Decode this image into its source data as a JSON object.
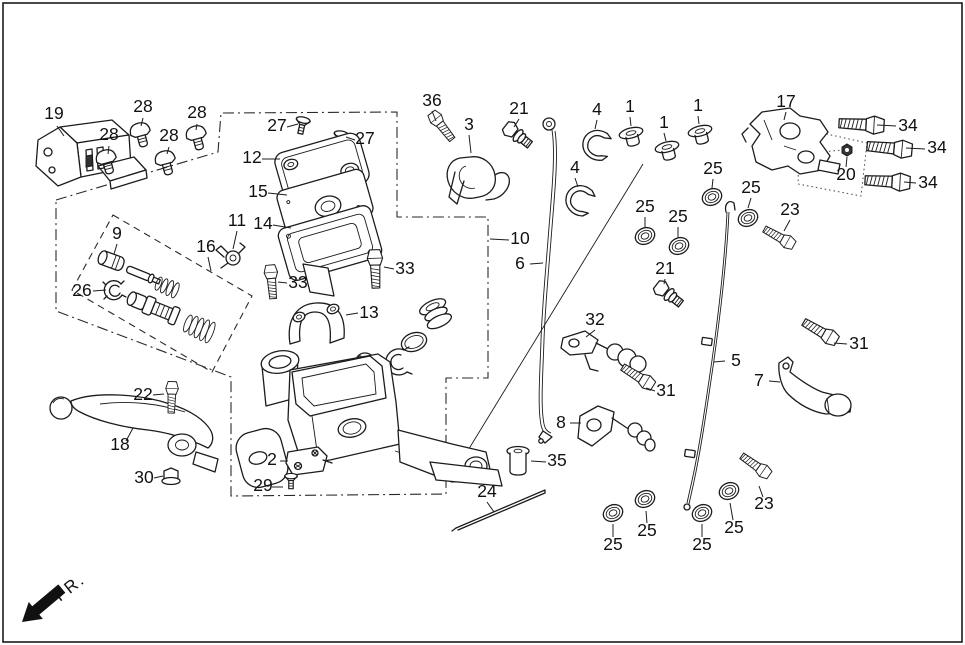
{
  "diagram": {
    "type": "exploded-parts-diagram",
    "subject": "brake master cylinder assembly",
    "fr_label": "FR.",
    "callouts": [
      {
        "part": "19",
        "x": 54,
        "y": 119,
        "leader": [
          [
            57,
            126
          ],
          [
            64,
            136
          ]
        ]
      },
      {
        "part": "28",
        "x": 109,
        "y": 140,
        "leader": [
          [
            109,
            146
          ],
          [
            108,
            154
          ]
        ]
      },
      {
        "part": "28",
        "x": 143,
        "y": 112,
        "leader": [
          [
            143,
            118
          ],
          [
            141,
            126
          ]
        ]
      },
      {
        "part": "28",
        "x": 169,
        "y": 141,
        "leader": [
          [
            169,
            147
          ],
          [
            167,
            154
          ]
        ]
      },
      {
        "part": "28",
        "x": 197,
        "y": 118,
        "leader": [
          [
            197,
            124
          ],
          [
            196,
            130
          ]
        ]
      },
      {
        "part": "27",
        "x": 277,
        "y": 131,
        "leader": [
          [
            287,
            127
          ],
          [
            298,
            124
          ]
        ]
      },
      {
        "part": "27",
        "x": 365,
        "y": 144,
        "leader": [
          [
            355,
            140
          ],
          [
            346,
            137
          ]
        ]
      },
      {
        "part": "12",
        "x": 252,
        "y": 163,
        "leader": [
          [
            262,
            159
          ],
          [
            280,
            159
          ]
        ]
      },
      {
        "part": "15",
        "x": 258,
        "y": 197,
        "leader": [
          [
            268,
            193
          ],
          [
            287,
            195
          ]
        ]
      },
      {
        "part": "14",
        "x": 263,
        "y": 229,
        "leader": [
          [
            273,
            225
          ],
          [
            291,
            228
          ]
        ]
      },
      {
        "part": "11",
        "x": 237,
        "y": 226,
        "leader": [
          [
            237,
            231
          ],
          [
            233,
            249
          ]
        ]
      },
      {
        "part": "16",
        "x": 206,
        "y": 252,
        "leader": [
          [
            208,
            257
          ],
          [
            211,
            271
          ]
        ]
      },
      {
        "part": "9",
        "x": 117,
        "y": 239,
        "leader": [
          [
            117,
            244
          ],
          [
            114,
            254
          ]
        ]
      },
      {
        "part": "26",
        "x": 82,
        "y": 296,
        "leader": [
          [
            93,
            291
          ],
          [
            106,
            290
          ]
        ]
      },
      {
        "part": "36",
        "x": 432,
        "y": 106,
        "leader": [
          [
            432,
            111
          ],
          [
            436,
            121
          ]
        ]
      },
      {
        "part": "3",
        "x": 469,
        "y": 130,
        "leader": [
          [
            469,
            135
          ],
          [
            471,
            153
          ]
        ]
      },
      {
        "part": "21",
        "x": 519,
        "y": 114,
        "leader": [
          [
            519,
            119
          ],
          [
            514,
            127
          ]
        ]
      },
      {
        "part": "4",
        "x": 597,
        "y": 115,
        "leader": [
          [
            597,
            120
          ],
          [
            595,
            129
          ]
        ]
      },
      {
        "part": "1",
        "x": 630,
        "y": 112,
        "leader": [
          [
            630,
            117
          ],
          [
            631,
            126
          ]
        ]
      },
      {
        "part": "1",
        "x": 664,
        "y": 128,
        "leader": [
          [
            664,
            133
          ],
          [
            666,
            141
          ]
        ]
      },
      {
        "part": "1",
        "x": 698,
        "y": 111,
        "leader": [
          [
            698,
            116
          ],
          [
            699,
            124
          ]
        ]
      },
      {
        "part": "4",
        "x": 575,
        "y": 173,
        "leader": [
          [
            575,
            178
          ],
          [
            578,
            187
          ]
        ]
      },
      {
        "part": "25",
        "x": 713,
        "y": 174,
        "leader": [
          [
            713,
            179
          ],
          [
            712,
            188
          ]
        ]
      },
      {
        "part": "10",
        "x": 520,
        "y": 244,
        "leader": [
          [
            509,
            240
          ],
          [
            490,
            239
          ]
        ]
      },
      {
        "part": "6",
        "x": 520,
        "y": 269,
        "leader": [
          [
            530,
            264
          ],
          [
            543,
            263
          ]
        ]
      },
      {
        "part": "25",
        "x": 645,
        "y": 212,
        "leader": [
          [
            645,
            217
          ],
          [
            645,
            227
          ]
        ]
      },
      {
        "part": "25",
        "x": 678,
        "y": 222,
        "leader": [
          [
            678,
            227
          ],
          [
            678,
            237
          ]
        ]
      },
      {
        "part": "21",
        "x": 665,
        "y": 274,
        "leader": [
          [
            665,
            279
          ],
          [
            664,
            284
          ]
        ]
      },
      {
        "part": "17",
        "x": 786,
        "y": 107,
        "leader": [
          [
            786,
            112
          ],
          [
            784,
            120
          ]
        ]
      },
      {
        "part": "20",
        "x": 846,
        "y": 180,
        "leader": [
          [
            846,
            167
          ],
          [
            847,
            157
          ]
        ]
      },
      {
        "part": "34",
        "x": 908,
        "y": 131,
        "leader": [
          [
            896,
            126
          ],
          [
            877,
            125
          ]
        ]
      },
      {
        "part": "34",
        "x": 937,
        "y": 153,
        "leader": [
          [
            925,
            149
          ],
          [
            906,
            148
          ]
        ]
      },
      {
        "part": "34",
        "x": 928,
        "y": 188,
        "leader": [
          [
            916,
            183
          ],
          [
            904,
            182
          ]
        ]
      },
      {
        "part": "23",
        "x": 790,
        "y": 215,
        "leader": [
          [
            790,
            220
          ],
          [
            784,
            231
          ]
        ]
      },
      {
        "part": "25",
        "x": 751,
        "y": 193,
        "leader": [
          [
            751,
            198
          ],
          [
            748,
            208
          ]
        ]
      },
      {
        "part": "32",
        "x": 595,
        "y": 325,
        "leader": [
          [
            595,
            330
          ],
          [
            586,
            337
          ]
        ]
      },
      {
        "part": "31",
        "x": 859,
        "y": 349,
        "leader": [
          [
            847,
            344
          ],
          [
            834,
            343
          ]
        ]
      },
      {
        "part": "31",
        "x": 666,
        "y": 396,
        "leader": [
          [
            655,
            391
          ],
          [
            646,
            388
          ]
        ]
      },
      {
        "part": "5",
        "x": 736,
        "y": 366,
        "leader": [
          [
            725,
            361
          ],
          [
            714,
            362
          ]
        ]
      },
      {
        "part": "7",
        "x": 759,
        "y": 386,
        "leader": [
          [
            769,
            381
          ],
          [
            780,
            382
          ]
        ]
      },
      {
        "part": "8",
        "x": 561,
        "y": 428,
        "leader": [
          [
            570,
            423
          ],
          [
            581,
            423
          ]
        ]
      },
      {
        "part": "35",
        "x": 557,
        "y": 466,
        "leader": [
          [
            546,
            462
          ],
          [
            531,
            461
          ]
        ]
      },
      {
        "part": "24",
        "x": 487,
        "y": 497,
        "leader": [
          [
            487,
            502
          ],
          [
            494,
            512
          ]
        ]
      },
      {
        "part": "25",
        "x": 613,
        "y": 550,
        "leader": [
          [
            613,
            537
          ],
          [
            613,
            524
          ]
        ]
      },
      {
        "part": "25",
        "x": 647,
        "y": 536,
        "leader": [
          [
            647,
            523
          ],
          [
            646,
            511
          ]
        ]
      },
      {
        "part": "25",
        "x": 702,
        "y": 550,
        "leader": [
          [
            702,
            537
          ],
          [
            702,
            524
          ]
        ]
      },
      {
        "part": "25",
        "x": 734,
        "y": 533,
        "leader": [
          [
            733,
            520
          ],
          [
            730,
            503
          ]
        ]
      },
      {
        "part": "23",
        "x": 764,
        "y": 509,
        "leader": [
          [
            763,
            497
          ],
          [
            759,
            486
          ]
        ]
      },
      {
        "part": "13",
        "x": 369,
        "y": 318,
        "leader": [
          [
            358,
            313
          ],
          [
            346,
            315
          ]
        ]
      },
      {
        "part": "33",
        "x": 298,
        "y": 288,
        "leader": [
          [
            287,
            283
          ],
          [
            278,
            282
          ]
        ]
      },
      {
        "part": "33",
        "x": 405,
        "y": 274,
        "leader": [
          [
            394,
            269
          ],
          [
            384,
            267
          ]
        ]
      },
      {
        "part": "22",
        "x": 143,
        "y": 400,
        "leader": [
          [
            153,
            395
          ],
          [
            164,
            394
          ]
        ]
      },
      {
        "part": "18",
        "x": 120,
        "y": 450,
        "leader": [
          [
            126,
            441
          ],
          [
            133,
            428
          ]
        ]
      },
      {
        "part": "30",
        "x": 144,
        "y": 483,
        "leader": [
          [
            154,
            478
          ],
          [
            163,
            476
          ]
        ]
      },
      {
        "part": "2",
        "x": 272,
        "y": 465,
        "leader": [
          [
            280,
            461
          ],
          [
            288,
            461
          ]
        ]
      },
      {
        "part": "29",
        "x": 263,
        "y": 491,
        "leader": [
          [
            272,
            487
          ],
          [
            283,
            487
          ]
        ]
      }
    ]
  }
}
